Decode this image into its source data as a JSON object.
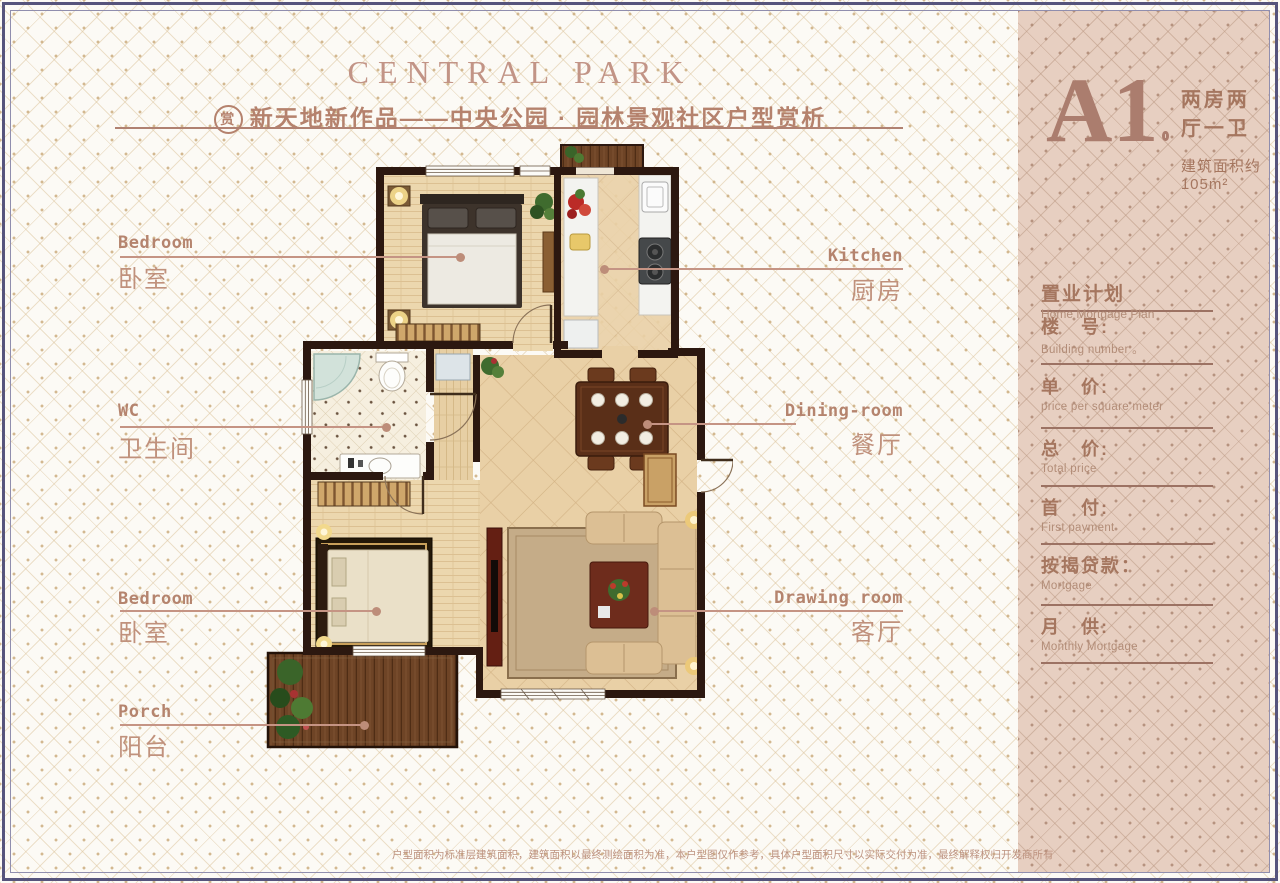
{
  "header": {
    "title": "CENTRAL PARK",
    "badge": "赏",
    "subtitle": "新天地新作品——中央公园 · 园林景观社区户型赏析"
  },
  "unit": {
    "code": "A1",
    "layout_desc": "两房两厅一卫",
    "area_desc": "建筑面积约 105m²"
  },
  "rooms": [
    {
      "en": "Bedroom",
      "zh": "卧室"
    },
    {
      "en": "WC",
      "zh": "卫生间"
    },
    {
      "en": "Bedroom",
      "zh": "卧室"
    },
    {
      "en": "Porch",
      "zh": "阳台"
    },
    {
      "en": "Kitchen",
      "zh": "厨房"
    },
    {
      "en": "Dining-room",
      "zh": "餐厅"
    },
    {
      "en": "Drawing room",
      "zh": "客厅"
    }
  ],
  "mortgage": {
    "title_zh": "置业计划",
    "title_en": "Home Mortgage Plan",
    "fields": [
      {
        "zh": "楼　号:",
        "en": "Building number 。"
      },
      {
        "zh": "单　价:",
        "en": "price per square meter"
      },
      {
        "zh": "总　价:",
        "en": "Total price"
      },
      {
        "zh": "首　付:",
        "en": "First payment"
      },
      {
        "zh": "按揭贷款：",
        "en": "Mortgage"
      },
      {
        "zh": "月　供:",
        "en": "Monthly Mortgage"
      }
    ]
  },
  "footer": {
    "disclaimer": "户型面积为标准层建筑面积，建筑面积以最终测绘面积为准，本户型图仅作参考，具体户型面积尺寸以实际交付为准，最终解释权归开发商所有"
  },
  "colors": {
    "accent_text": "#b5846e",
    "panel_bg": "#e7cfc1",
    "frame": "#56547c",
    "wall": "#2c1810",
    "leader_line": "#c59484"
  }
}
